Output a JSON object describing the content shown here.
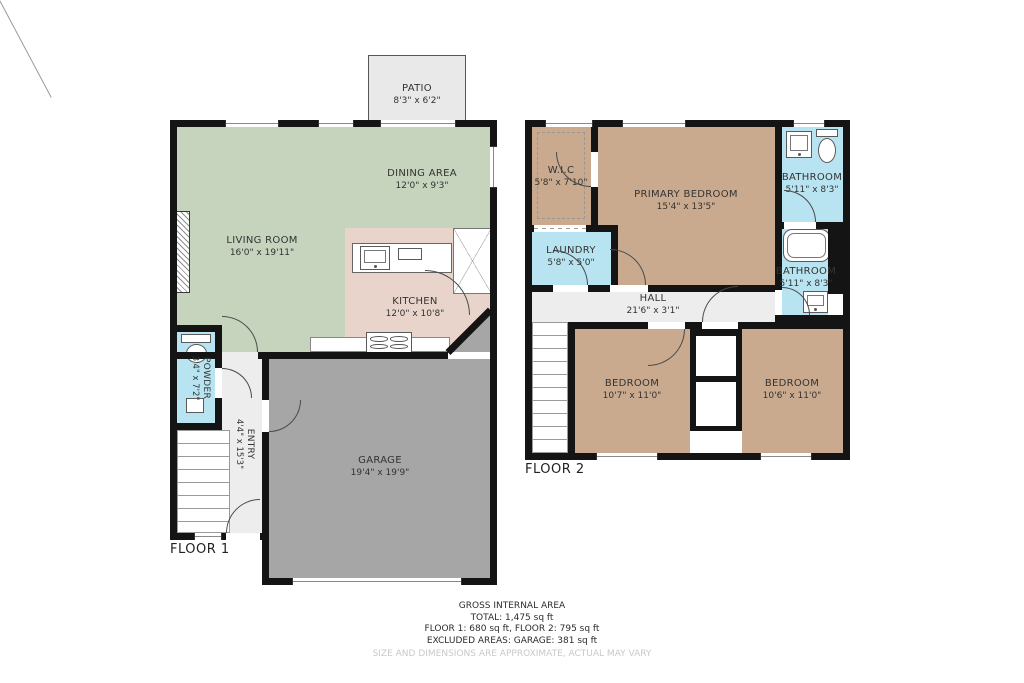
{
  "floor1": {
    "label": "FLOOR 1",
    "rooms": {
      "patio": {
        "name": "PATIO",
        "dims": "8'3\" x 6'2\""
      },
      "dining": {
        "name": "DINING AREA",
        "dims": "12'0\" x 9'3\""
      },
      "living": {
        "name": "LIVING ROOM",
        "dims": "16'0\" x 19'11\""
      },
      "kitchen": {
        "name": "KITCHEN",
        "dims": "12'0\" x 10'8\""
      },
      "powder": {
        "name": "POWDER",
        "dims": "3'4\" x 7'2\""
      },
      "entry": {
        "name": "ENTRY",
        "dims": "4'4\" x 15'3\""
      },
      "garage": {
        "name": "GARAGE",
        "dims": "19'4\" x 19'9\""
      }
    }
  },
  "floor2": {
    "label": "FLOOR 2",
    "rooms": {
      "wic": {
        "name": "W.I.C",
        "dims": "5'8\" x 7'10\""
      },
      "primary": {
        "name": "PRIMARY BEDROOM",
        "dims": "15'4\" x 13'5\""
      },
      "bathroom_top": {
        "name": "BATHROOM",
        "dims": "5'11\" x 8'3\""
      },
      "laundry": {
        "name": "LAUNDRY",
        "dims": "5'8\" x 5'0\""
      },
      "bathroom_mid": {
        "name": "BATHROOM",
        "dims": "5'11\" x 8'3\""
      },
      "hall": {
        "name": "HALL",
        "dims": "21'6\" x 3'1\""
      },
      "bedroom_left": {
        "name": "BEDROOM",
        "dims": "10'7\" x 11'0\""
      },
      "bedroom_right": {
        "name": "BEDROOM",
        "dims": "10'6\" x 11'0\""
      }
    }
  },
  "summary": {
    "title": "GROSS INTERNAL AREA",
    "total": "TOTAL: 1,475 sq ft",
    "floors": "FLOOR 1: 680 sq ft, FLOOR 2: 795 sq ft",
    "excluded": "EXCLUDED AREAS: GARAGE: 381 sq ft",
    "disclaimer": "SIZE AND DIMENSIONS ARE APPROXIMATE, ACTUAL MAY VARY"
  },
  "colors": {
    "living_area": "#c6d3bd",
    "kitchen": "#e9d4cb",
    "bedroom": "#c9aa8e",
    "bathroom": "#b8e4f1",
    "garage": "#a6a6a6",
    "hall": "#ededed",
    "patio": "#e9e9e9",
    "wall": "#141414"
  }
}
